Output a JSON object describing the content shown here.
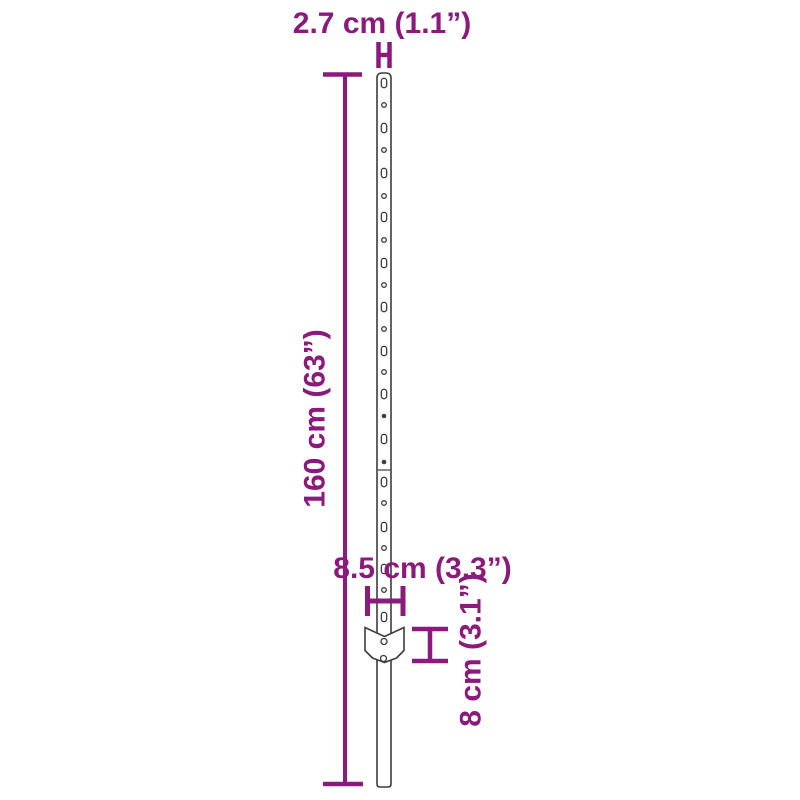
{
  "diagram": {
    "accent_color": "#8b1a7c",
    "outline_color": "#3d3d3d",
    "background_color": "#ffffff",
    "labels": {
      "post_width": "2.7 cm (1.1”)",
      "post_height": "160 cm (63”)",
      "plate_width": "8.5 cm (3.3”)",
      "plate_height": "8 cm (3.1”)"
    },
    "post": {
      "left": 377,
      "right": 391,
      "top": 73,
      "bottom": 787,
      "seam_y": 470
    },
    "holes": {
      "center_x": 384,
      "slot_ys": [
        83,
        128,
        173,
        217,
        263,
        307,
        351,
        394,
        439,
        482,
        527,
        569,
        617
      ],
      "circle_ys": [
        105,
        150,
        196,
        240,
        285,
        329,
        372,
        503,
        548,
        590
      ],
      "filled_circle_ys": [
        416,
        462
      ],
      "slot_width": 5.4,
      "slot_height": 9.4,
      "circle_radius": 2.3
    },
    "plate": {
      "points": "365,627.5 384.5,636.5 404,627.5 404,650.5 396.5,658 384.5,662.5 372.5,658 365,650.5",
      "holes": [
        {
          "cx": 384,
          "cy": 641.5,
          "r": 3
        },
        {
          "cx": 383.5,
          "cy": 658.5,
          "r": 3
        }
      ]
    }
  }
}
